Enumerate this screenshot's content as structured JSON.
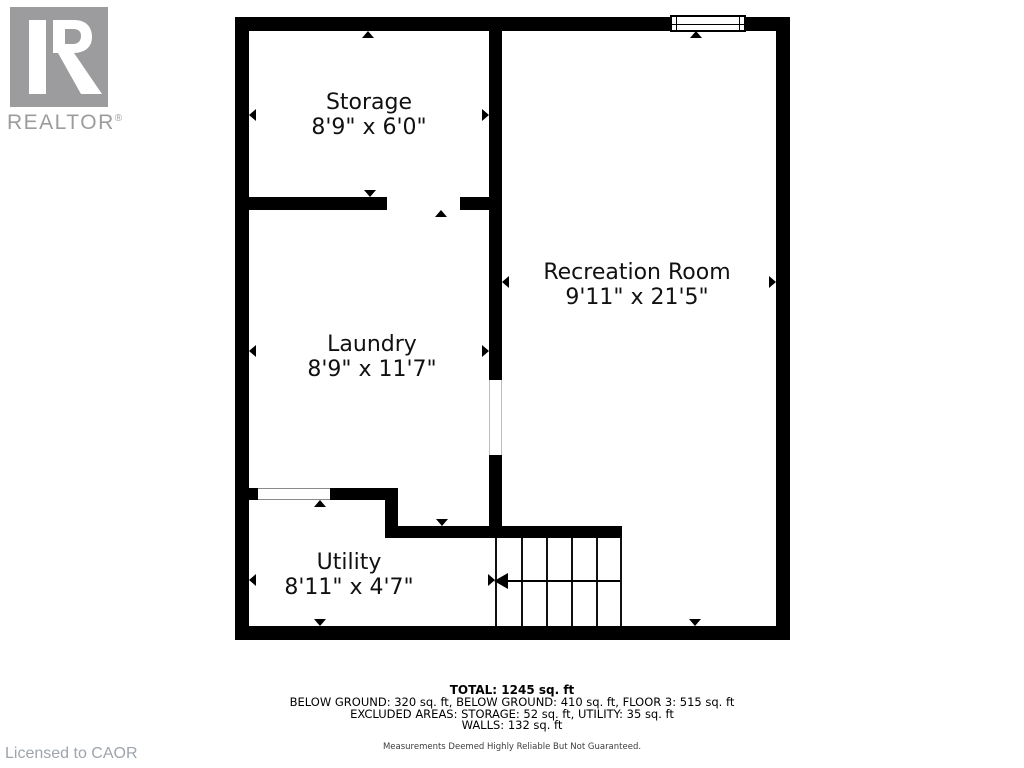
{
  "colors": {
    "page_bg": "#ffffff",
    "wall": "#000000",
    "logo_gray": "#9c9c9e",
    "licensed_gray": "#9ea4ac"
  },
  "branding": {
    "logo_word": "REALTOR",
    "registered_mark": "®",
    "licensed_text": "Licensed to CAOR"
  },
  "floorplan": {
    "rooms": {
      "storage": {
        "name": "Storage",
        "dims": "8'9\" x 6'0\""
      },
      "recreation": {
        "name": "Recreation Room",
        "dims": "9'11\" x 21'5\""
      },
      "laundry": {
        "name": "Laundry",
        "dims": "8'9\" x 11'7\""
      },
      "utility": {
        "name": "Utility",
        "dims": "8'11\" x 4'7\""
      }
    }
  },
  "summary": {
    "total": "TOTAL: 1245 sq. ft",
    "below_ground_line": "BELOW GROUND: 320 sq. ft, BELOW GROUND: 410 sq. ft, FLOOR 3: 515 sq. ft",
    "excluded_line": "EXCLUDED AREAS: STORAGE: 52 sq. ft, UTILITY: 35 sq. ft",
    "walls_line": "WALLS: 132 sq. ft",
    "disclaimer": "Measurements Deemed Highly Reliable But Not Guaranteed."
  }
}
